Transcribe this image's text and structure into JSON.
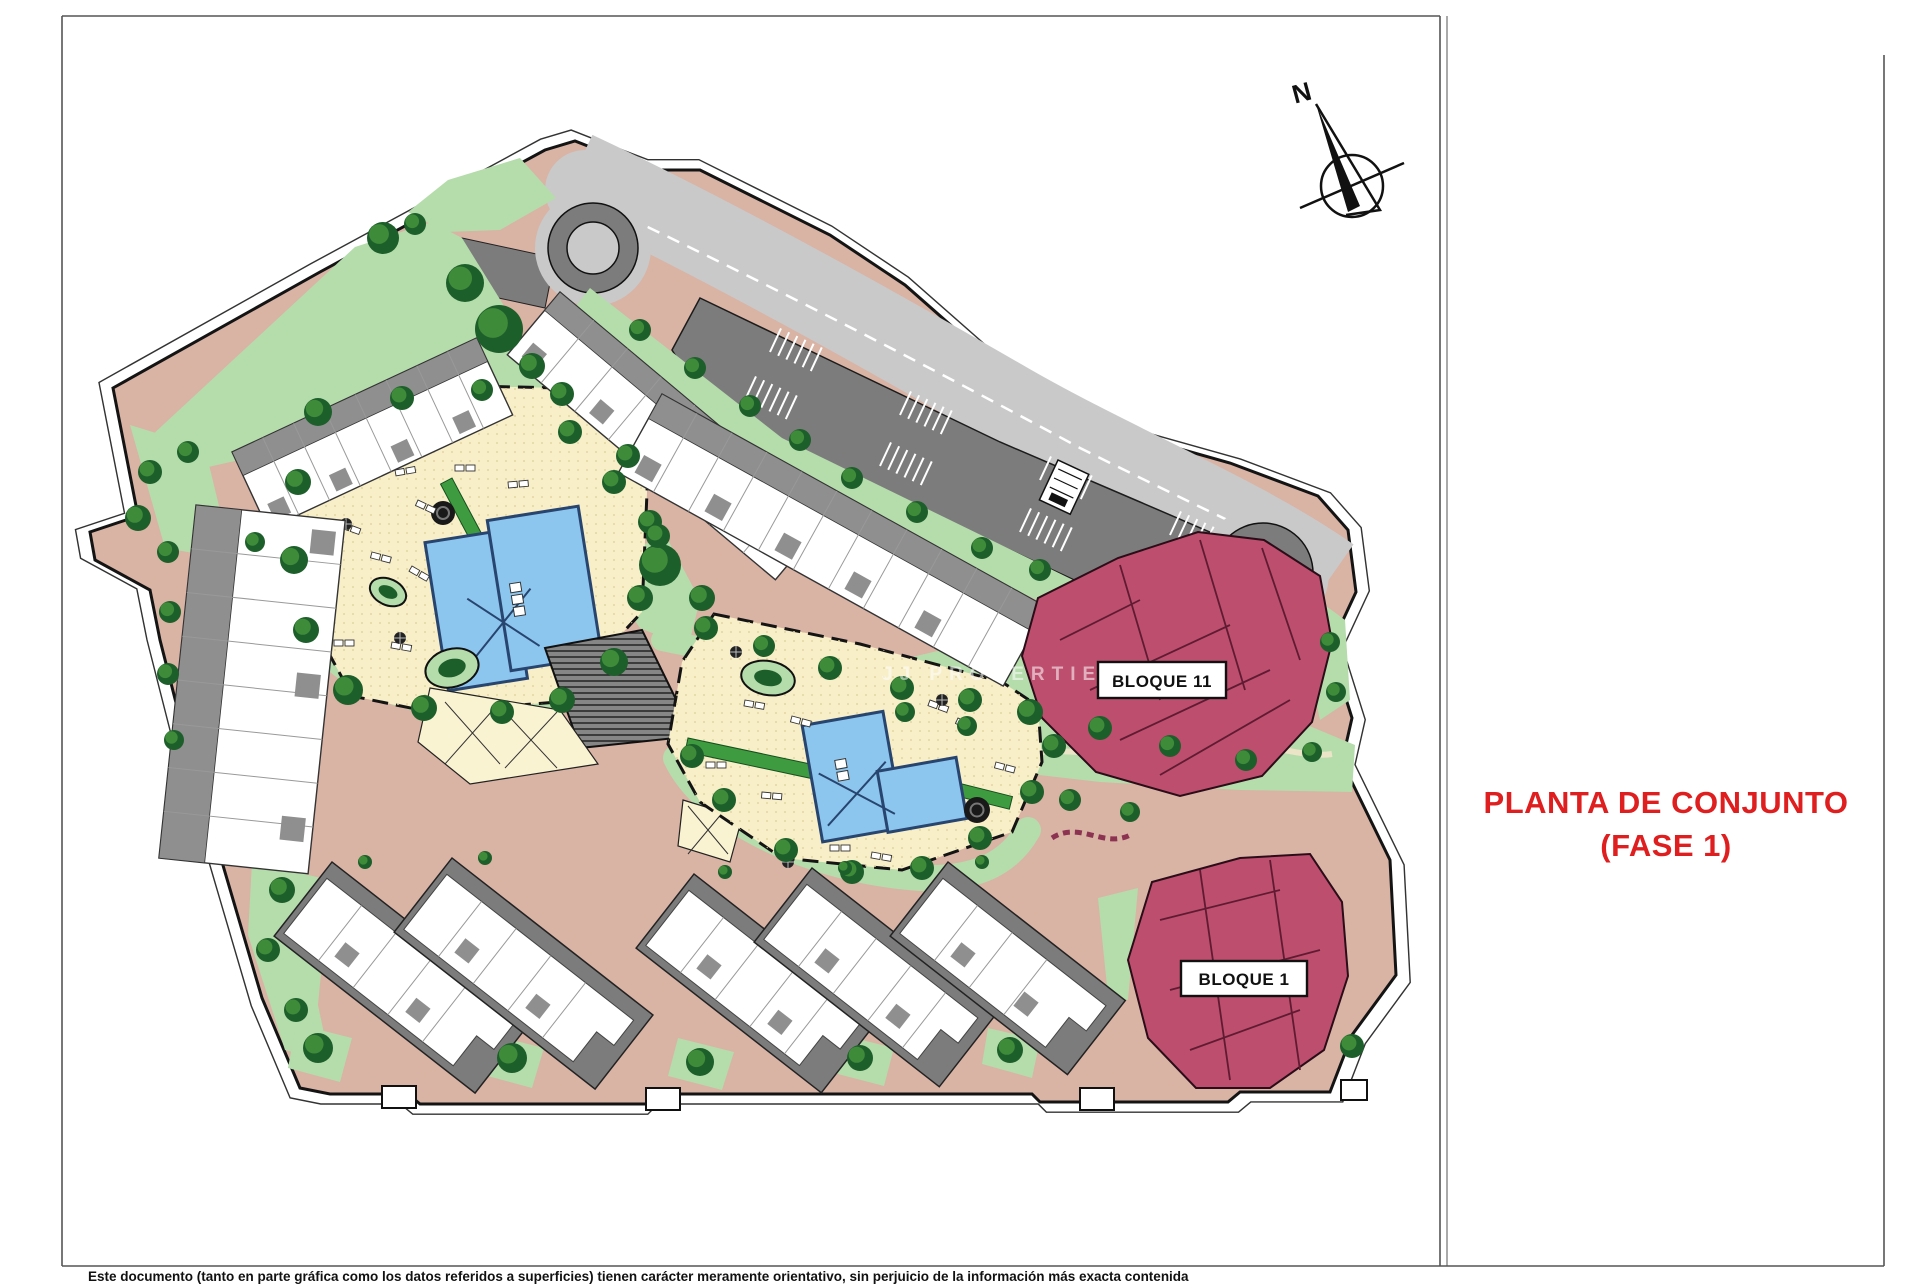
{
  "document": {
    "title_line1": "PLANTA DE CONJUNTO",
    "title_line2": "(FASE 1)",
    "disclaimer": "Este documento (tanto en parte gráfica como los datos referidos a superficies) tienen carácter meramente orientativo, sin perjuicio de la información más exacta contenida",
    "watermark": "JJ PROPERTIES"
  },
  "compass": {
    "north_label": "N"
  },
  "plan": {
    "block_labels": {
      "bloque_11": "BLOQUE 11",
      "bloque_1": "BLOQUE 1"
    }
  },
  "colors": {
    "title-red": "#df1f1f",
    "path-salmon": "#d9b3a4",
    "green-light": "#b5dcab",
    "green-strip": "#3f9b3f",
    "tree-dark": "#1d5f2a",
    "tree-mid": "#44933c",
    "deck-cream": "#f8efc8",
    "pool-blue": "#8cc6ef",
    "pool-dark": "#27456e",
    "road-light": "#c9c9c9",
    "parking-dark": "#7c7c7c",
    "roof-gray": "#8f8f8f",
    "bloque-maroon": "#bd4e6e",
    "bloque-line": "#5f1b32"
  }
}
